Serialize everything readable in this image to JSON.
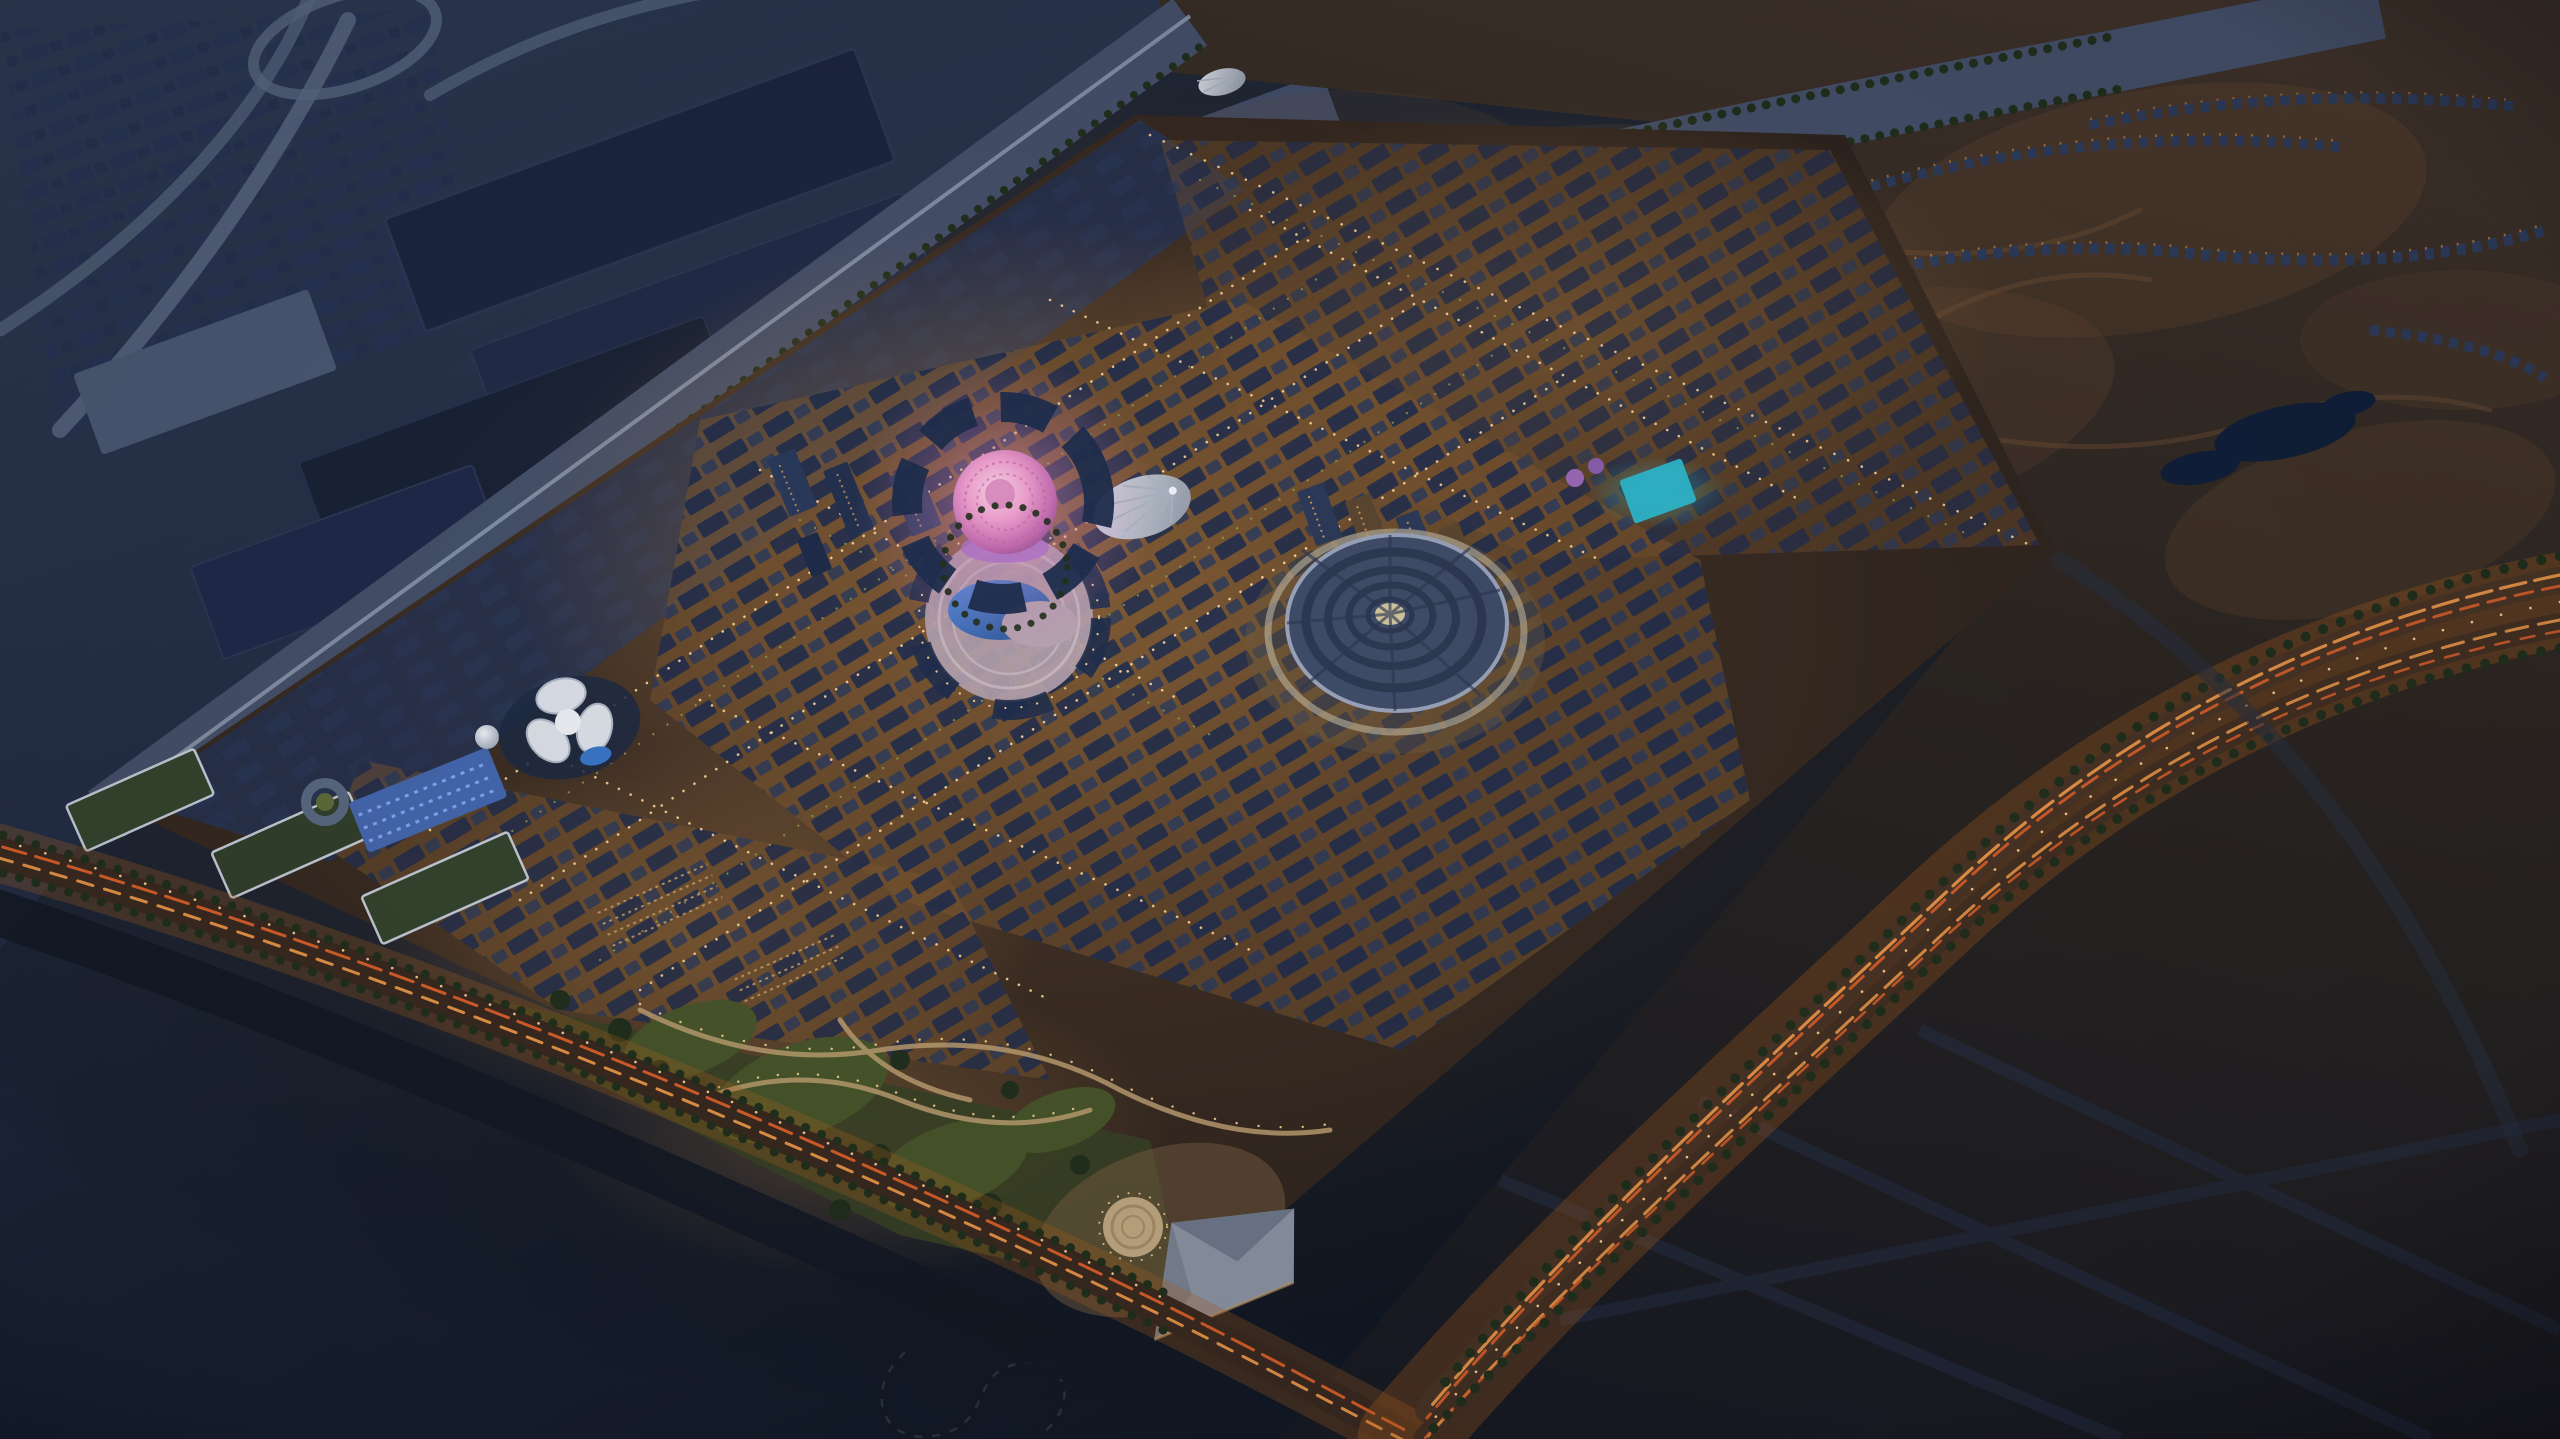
{
  "scene": {
    "title": "Aerial dusk rendering of a desert expo master-plan city",
    "description": "High-angle aerial rendering at dusk of a diamond-shaped, warmly illuminated expo city surrounded by dark desert. A glowing pink latticed dome sits at the heart of dense amber-lit districts with navy rooftops; nearby are a white pleated canopy pavilion, a ribbed circular pavilion, a crescent reflecting pool in a round plaza, a white trefoil pavilion, green parks with winding paths, a circular plaza and a faceted stage building. Dark exhibition halls and highway interchanges occupy the upper left; villa compounds, a small lake and an orange-lit highway curve through the desert on the right.",
    "time_of_day": "dusk",
    "camera": "oblique high-angle aerial view",
    "contains_text": false
  },
  "palette": {
    "bg_top": "#2b3752",
    "bg_mid": "#1a2334",
    "bg_deep": "#0b1019",
    "slate_terrain": "#2e3a54",
    "town_block": "#283356",
    "hall_roof": "#1c2640",
    "hall_roof_mid": "#222c48",
    "hall_roof_light": "#4b5974",
    "road_ribbon": "#5a6982",
    "corridor": "#46516b",
    "rail_line": "#8a97ad",
    "desert_warm": "#41332a",
    "desert_shadow": "#191b24",
    "sand_glow": "#6b4c33",
    "site_base": "#372a21",
    "site_glow": "#c08a4c",
    "street_amber": "#d59a55",
    "street_warm_under": "#7a5530",
    "light_dot": "#ffd79a",
    "lane_orange": "#f09a4a",
    "lane_red": "#e0622a",
    "highway_glow": "#b5651d",
    "roof_navy": "#1f2d4d",
    "roof_navy_light": "#2a3a5c",
    "tower_warm": "#5a4630",
    "tree_dark": "#22301d",
    "tree_lit": "#9aa84e",
    "park_green": "#49562b",
    "path_tan": "#bd9f72",
    "plaza_mauve": "#b4a2ae",
    "pool_blue": "#3a76c8",
    "pool_deep": "#27508e",
    "dome_pink": "#ee9fce",
    "dome_pink_hi": "#f7d2e6",
    "dome_pink_deep": "#8d4f8e",
    "canopy_white": "#dde2ea",
    "canopy_shade": "#9aa2b0",
    "terra_disc": "#3f4c68",
    "terra_ring": "#2d3852",
    "terra_rim": "#98a2b8",
    "terra_center": "#cfc49e",
    "stage_grey": "#8e96a6",
    "stage_shade": "#707a8c",
    "mosaic_blue": "#4668b0",
    "cyan_pavilion": "#2fb9cf",
    "villa_roof": "#2e3d5e",
    "villa_light": "#b0793c",
    "lake_blue": "#10203a",
    "asphalt_dark": "#141a26"
  },
  "landmarks": [
    {
      "id": "al-wasl-dome",
      "label": "Glowing pink latticed dome",
      "location": "center of site"
    },
    {
      "id": "amphitheater-pool",
      "label": "Round plaza with crescent reflecting pool",
      "location": "just south of the dome"
    },
    {
      "id": "canopy-pavilion",
      "label": "White pleated cone canopy",
      "location": "east of the dome"
    },
    {
      "id": "terra-dome",
      "label": "Ribbed circular pavilion disc",
      "location": "center-right"
    },
    {
      "id": "trefoil-pavilion",
      "label": "White trefoil-roofed pavilion",
      "location": "west of center"
    },
    {
      "id": "observation-sphere",
      "label": "Small white sphere structure",
      "location": "west edge of site"
    },
    {
      "id": "mosaic-gateway",
      "label": "Blue mosaic-lit gateway building",
      "location": "southwest edge"
    },
    {
      "id": "stage-building",
      "label": "Grey faceted stage hall",
      "location": "south corner"
    },
    {
      "id": "circular-plaza",
      "label": "Circular paved plaza",
      "location": "southern park"
    },
    {
      "id": "central-park",
      "label": "Lawns, trees and winding lit paths",
      "location": "south of site"
    },
    {
      "id": "exhibition-halls",
      "label": "Large dark exhibition halls",
      "location": "upper left"
    },
    {
      "id": "highway-interchange",
      "label": "Looping highway interchange",
      "location": "top left"
    },
    {
      "id": "monorail-corridor",
      "label": "Straight rail and road corridor",
      "location": "northwest edge"
    },
    {
      "id": "green-corridor",
      "label": "Tree-lined corridor",
      "location": "northeast edge"
    },
    {
      "id": "illuminated-highway",
      "label": "Orange-lit curving highway",
      "location": "right side"
    },
    {
      "id": "expo-boulevard",
      "label": "Orange-lit boulevard",
      "location": "southwest edge"
    },
    {
      "id": "villa-compounds",
      "label": "Rows of villa compounds",
      "location": "upper right desert"
    },
    {
      "id": "desert-lake",
      "label": "Small dark lake",
      "location": "upper right"
    },
    {
      "id": "karting-track",
      "label": "Small looping track",
      "location": "bottom center"
    },
    {
      "id": "cyan-pavilion",
      "label": "Cyan-glowing box pavilion",
      "location": "north of disc pavilion"
    },
    {
      "id": "tower-clusters",
      "label": "High-rise tower clusters",
      "location": "center of site"
    },
    {
      "id": "district-grids",
      "label": "Dense amber-lit blocks with navy roofs",
      "location": "across site"
    }
  ]
}
